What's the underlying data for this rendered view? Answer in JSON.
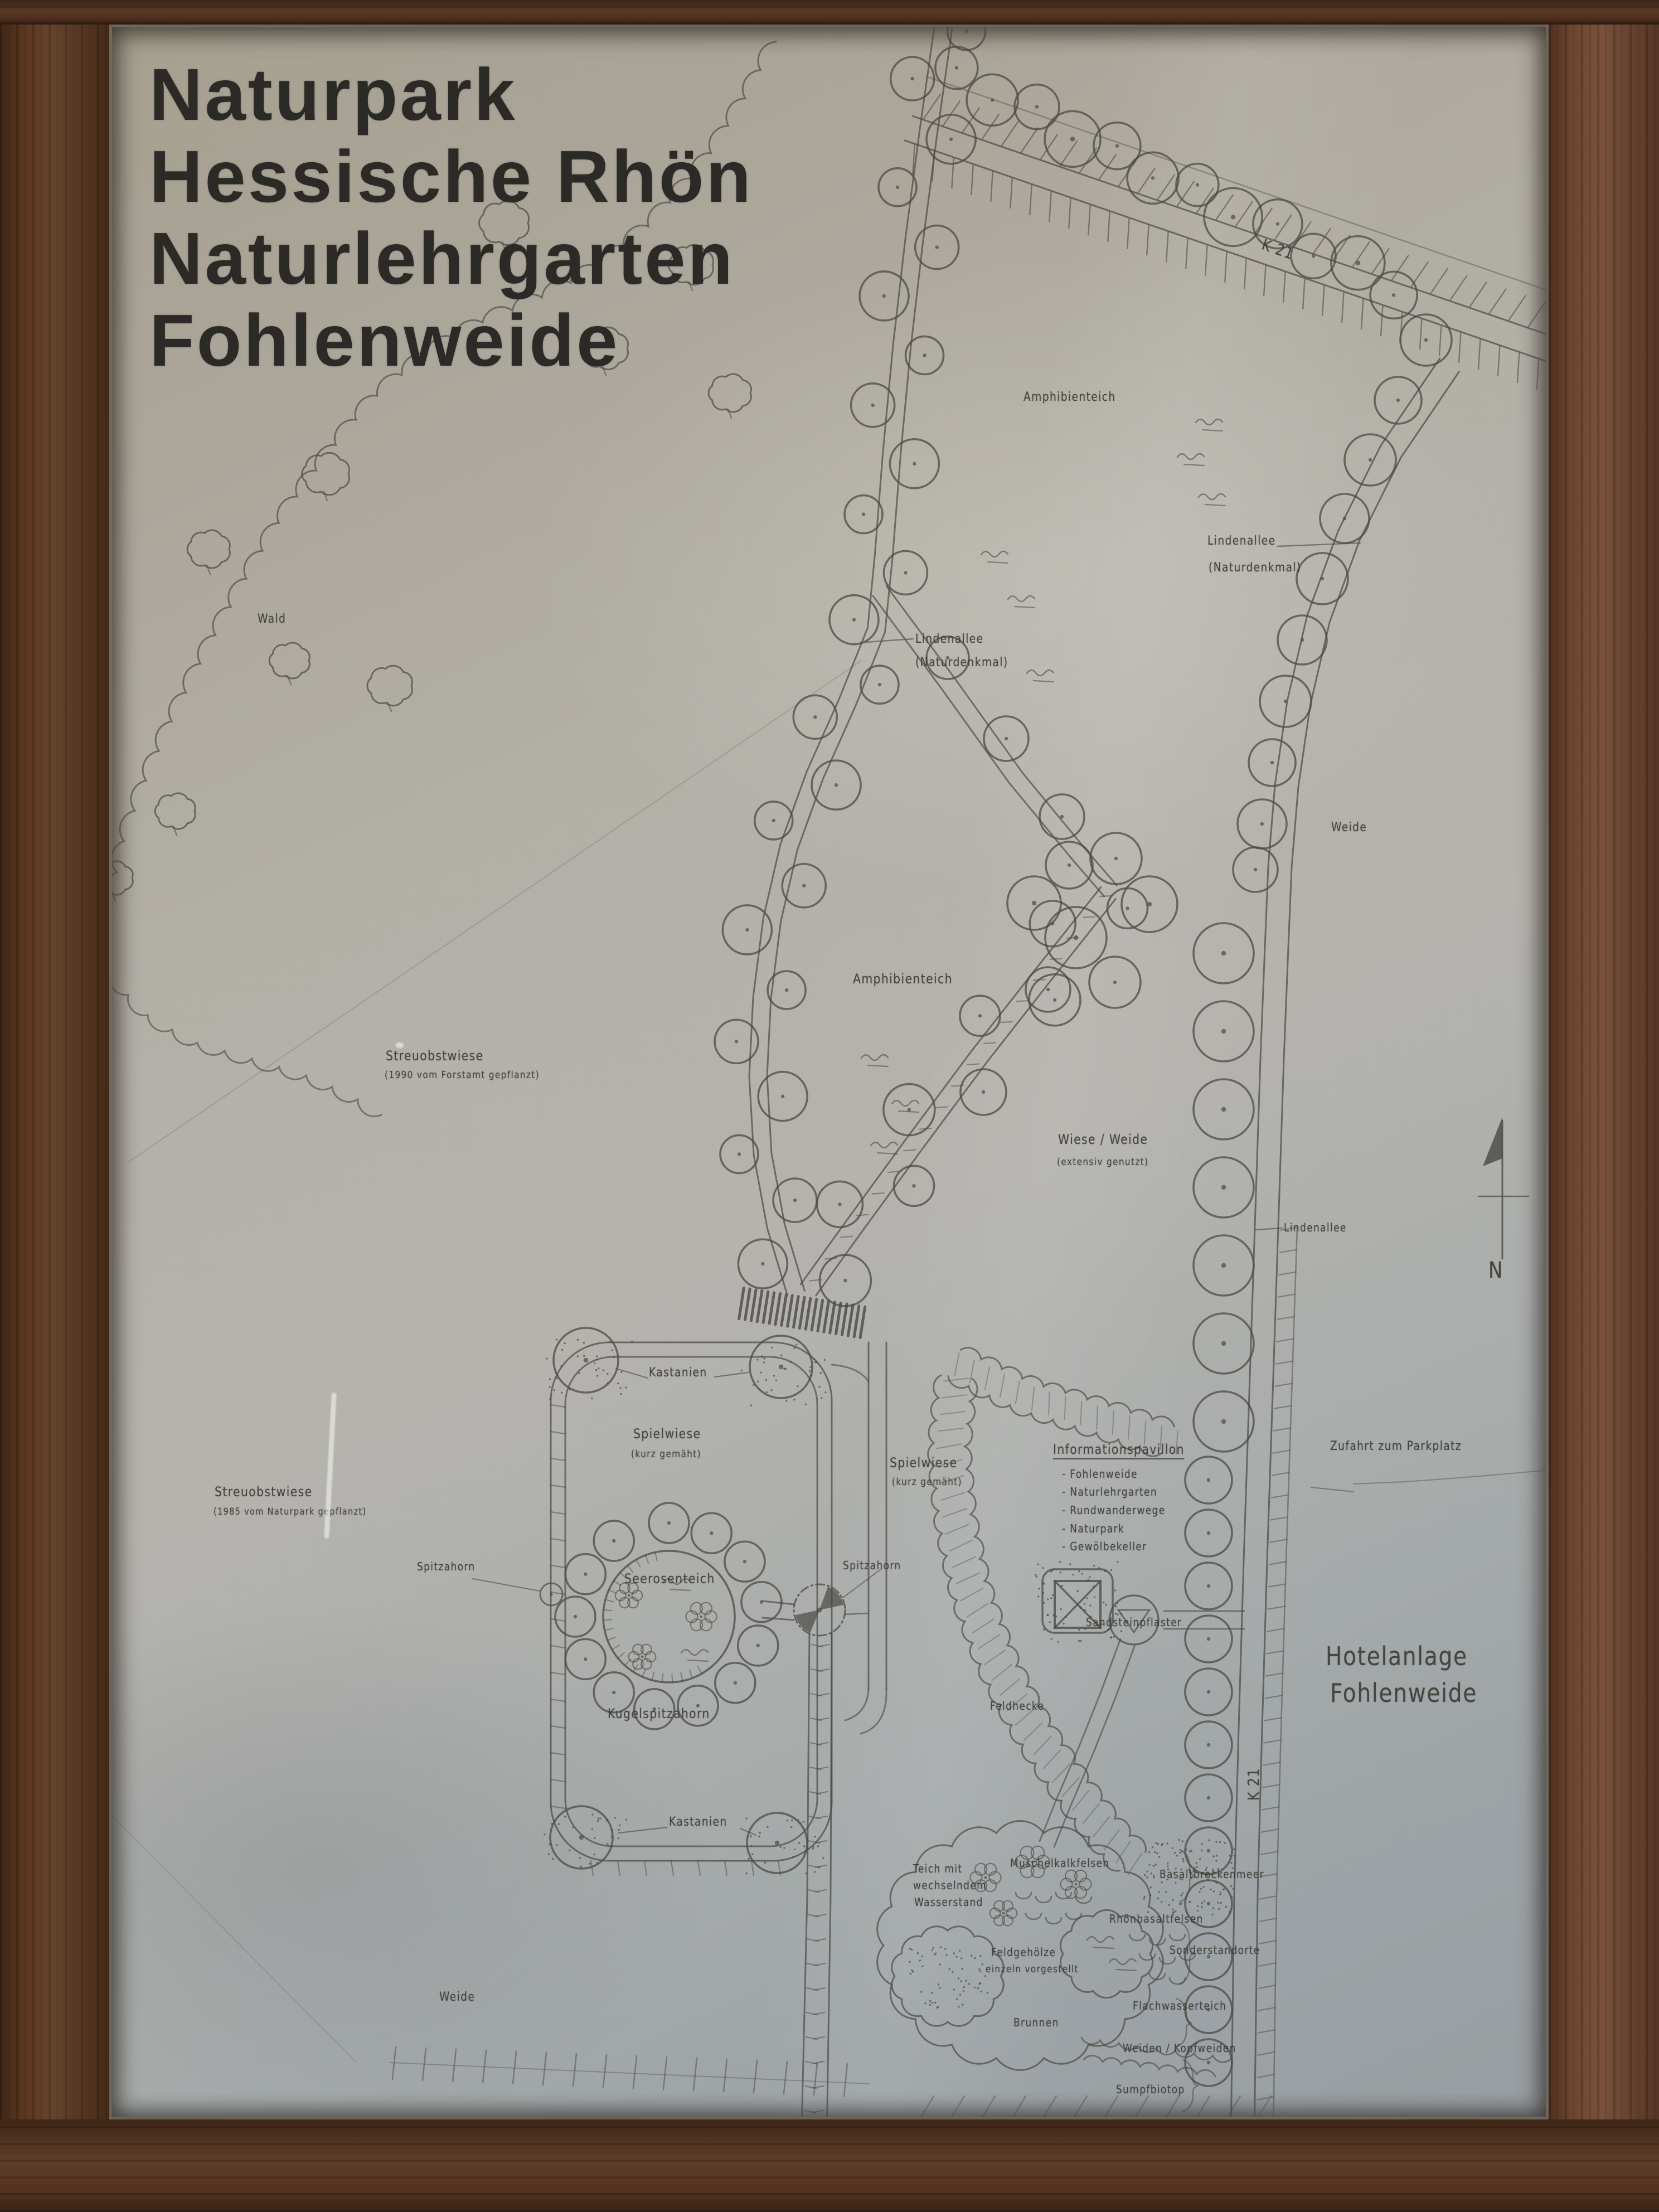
{
  "sign": {
    "title_lines": [
      "Naturpark",
      "Hessische Rhön",
      "Naturlehrgarten",
      "Fohlenweide"
    ]
  },
  "compass": {
    "north_label": "N"
  },
  "roads": {
    "k21": "K 21"
  },
  "labels": {
    "wald": "Wald",
    "weide": "Weide",
    "amphibienteich": "Amphibienteich",
    "lindenallee": "Lindenallee",
    "naturdenkmal": "(Naturdenkmal)",
    "streuobstwiese": "Streuobstwiese",
    "streuobst_1990": "(1990 vom Forstamt gepflanzt)",
    "streuobst_1985": "(1985 vom Naturpark gepflanzt)",
    "wiese_weide": "Wiese / Weide",
    "extensiv_genutzt": "(extensiv genutzt)",
    "spielwiese": "Spielwiese",
    "kurz_gemaeht": "(kurz gemäht)",
    "kastanien": "Kastanien",
    "seerosenteich": "Seerosenteich",
    "kugelspitzahorn": "Kugelspitzahorn",
    "spitzahorn": "Spitzahorn",
    "zufahrt_parkplatz": "Zufahrt zum Parkplatz",
    "hotelanlage": "Hotelanlage",
    "fohlenweide": "Fohlenweide",
    "sandsteinpflaster": "Sandsteinpflaster",
    "feldhecke": "Feldhecke",
    "teich_line1": "Teich mit",
    "teich_line2": "wechselndem",
    "teich_line3": "Wasserstand",
    "muschelkalkfelsen": "Muschelkalkfelsen",
    "basaltbrockenmeer": "Basaltbrockenmeer",
    "rhoenbasaltfelsen": "Rhönbasaltfelsen",
    "feldgehoelze_line1": "Feldgehölze",
    "feldgehoelze_line2": "einzeln vorgestellt",
    "sonderstandorte": "Sonderstandorte",
    "flachwasserteich": "Flachwasserteich",
    "brunnen": "Brunnen",
    "weiden_kopfweiden": "Weiden / Kopfweiden",
    "sumpfbiotop": "Sumpfbiotop"
  },
  "infopavillon": {
    "title": "Informationspavillon",
    "items": [
      "- Fohlenweide",
      "- Naturlehrgarten",
      "- Rundwanderwege",
      "- Naturpark",
      "- Gewölbekeller"
    ]
  },
  "colors": {
    "wood_frame": "#59361f",
    "panel": "#b3b0a8",
    "map_ink": "#4b4943",
    "title_text": "#2c2a26"
  }
}
